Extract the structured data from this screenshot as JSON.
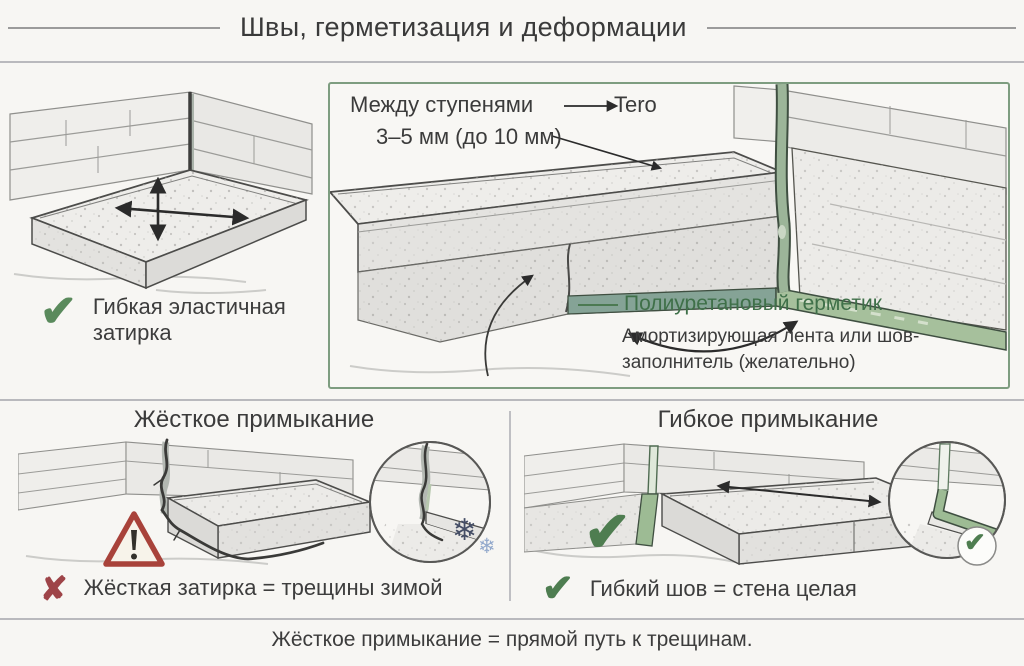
{
  "header": {
    "title": "Швы, герметизация и деформации"
  },
  "top_left": {
    "caption_line1": "Гибкая эластичная",
    "caption_line2": "затирка"
  },
  "detail_box": {
    "gap_label": "Между ступенями",
    "gap_target": "Tero",
    "gap_size": "3–5 мм (до 10 мм)",
    "sealant_label": "Полиуретановый герметик",
    "tape_line1": "Амортизирующая лента или шов-",
    "tape_line2": "заполнитель (желательно)"
  },
  "bottom_left": {
    "title": "Жёсткое примыкание",
    "caption": "Жёсткая затирка = трещины зимой"
  },
  "bottom_right": {
    "title": "Гибкое примыкание",
    "caption": "Гибкий шов = стена целая"
  },
  "footer": {
    "note": "Жёсткое примыкание = прямой путь к трещинам."
  },
  "icons": {
    "check": "✔",
    "cross": "✘",
    "snowflake": "❄",
    "warning": "!"
  },
  "colors": {
    "background": "#f7f6f3",
    "text": "#3c3c3c",
    "divider": "#b9b9bd",
    "box_border": "#7e9d80",
    "accent_green": "#3f7049",
    "check_green": "#4e7d50",
    "sealant_green": "#9dbb94",
    "error_red": "#9e4448",
    "warning_red": "#a8423a",
    "snowflake_dark": "#454e66",
    "snowflake_light": "#93a9cc"
  }
}
